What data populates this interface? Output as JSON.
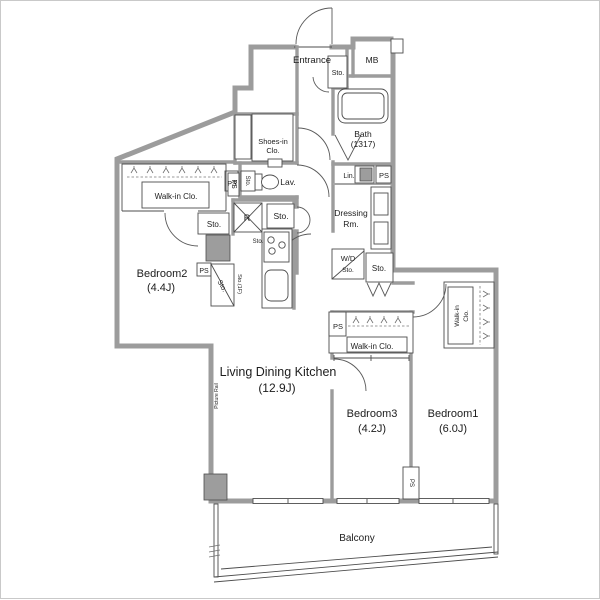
{
  "plan": {
    "title": "Apartment floor plan (3LDK)",
    "colors": {
      "wall": "#9c9c9c",
      "line": "#4d4d4d",
      "gray_fixture": "#9d9d9d",
      "text": "#1d1d1d",
      "background": "#ffffff"
    },
    "labels": {
      "entrance": "Entrance",
      "entrance_sto": "Sto.",
      "mb": "MB",
      "bath_name": "Bath",
      "bath_size": "(1317)",
      "lin": "Lin.",
      "ps_bath": "PS",
      "shoes_clo_1": "Shoes-in",
      "shoes_clo_2": "Clo.",
      "sto_lav": "Sto.",
      "lav": "Lav.",
      "ps_lav": "PS",
      "refrigerator": "R",
      "sto_hall_upper": "Sto.",
      "sto_kitchen": "Sto.",
      "dressing_1": "Dressing",
      "dressing_2": "Rm.",
      "wd": "W/D",
      "sto_wd": "Sto.",
      "sto_dressing": "Sto.",
      "walkin_b2": "Walk-in Clo.",
      "ps_b2": "PS",
      "sto_b2": "Sto.",
      "ps_kitchen": "PS",
      "sto_diag": "Sto.",
      "sto_1f": "Sto.(1F)",
      "bedroom2_name": "Bedroom2",
      "bedroom2_size": "(4.4J)",
      "ldk_name": "Living Dining Kitchen",
      "ldk_size": "(12.9J)",
      "picture_rail": "Picture Rail",
      "walkin_b3": "Walk-in Clo.",
      "ps_b3": "PS",
      "bedroom3_name": "Bedroom3",
      "bedroom3_size": "(4.2J)",
      "bedroom1_name": "Bedroom1",
      "bedroom1_size": "(6.0J)",
      "walkin_b1_1": "Walk-in",
      "walkin_b1_2": "Clo.",
      "ps_b1": "PS",
      "balcony": "Balcony"
    }
  }
}
